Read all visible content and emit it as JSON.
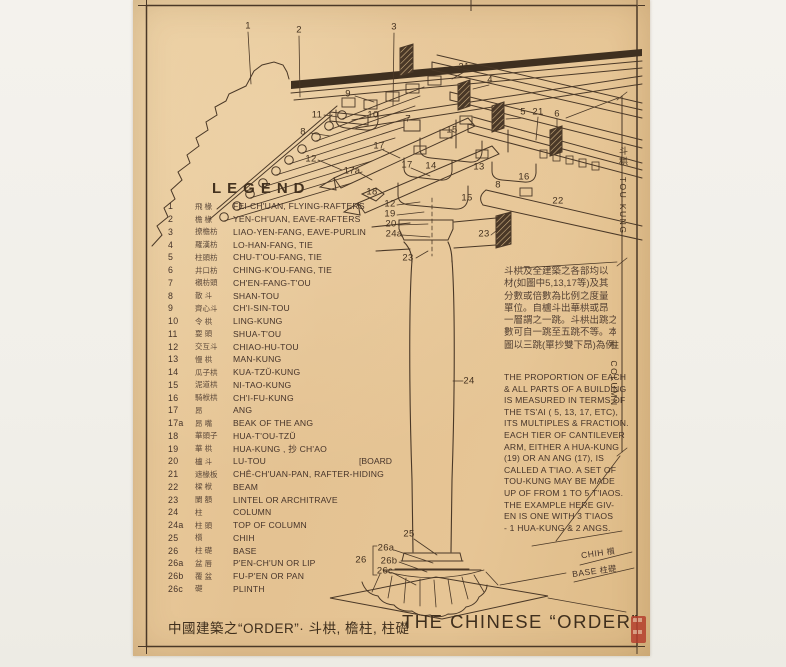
{
  "colors": {
    "background": "#f3f1ec",
    "paper": "#e6c596",
    "ink": "#4a3827",
    "seal_red": "#b5402e"
  },
  "legend": {
    "heading": "LEGEND",
    "items": [
      {
        "num": "1",
        "cn": "飛 椽",
        "en": "FEI-CH'UAN, FLYING-RAFTERS"
      },
      {
        "num": "2",
        "cn": "檐 椽",
        "en": "YEN-CH'UAN, EAVE-RAFTERS"
      },
      {
        "num": "3",
        "cn": "撩檐枋",
        "en": "LIAO-YEN-FANG, EAVE-PURLIN"
      },
      {
        "num": "4",
        "cn": "羅漢枋",
        "en": "LO-HAN-FANG, TIE"
      },
      {
        "num": "5",
        "cn": "柱頭枋",
        "en": "CHU-T'OU-FANG, TIE"
      },
      {
        "num": "6",
        "cn": "井口枋",
        "en": "CHING-K'OU-FANG, TIE"
      },
      {
        "num": "7",
        "cn": "襯枋頭",
        "en": "CH'EN-FANG-T'OU"
      },
      {
        "num": "8",
        "cn": "散 斗",
        "en": "SHAN-TOU"
      },
      {
        "num": "9",
        "cn": "齊心斗",
        "en": "CH'I-SIN-TOU"
      },
      {
        "num": "10",
        "cn": "令 栱",
        "en": "LING-KUNG"
      },
      {
        "num": "11",
        "cn": "耍 頭",
        "en": "SHUA-T'OU"
      },
      {
        "num": "12",
        "cn": "交互斗",
        "en": "CHIAO-HU-TOU"
      },
      {
        "num": "13",
        "cn": "慢 栱",
        "en": "MAN-KUNG"
      },
      {
        "num": "14",
        "cn": "瓜子栱",
        "en": "KUA-TZŬ-KUNG"
      },
      {
        "num": "15",
        "cn": "泥道栱",
        "en": "NI-TAO-KUNG"
      },
      {
        "num": "16",
        "cn": "騎栿栱",
        "en": "CH'I-FU-KUNG"
      },
      {
        "num": "17",
        "cn": "昂",
        "en": "ANG"
      },
      {
        "num": "17a",
        "cn": "昂 嘴",
        "en": "BEAK OF THE ANG"
      },
      {
        "num": "18",
        "cn": "華頭子",
        "en": "HUA-T'OU-TZŬ"
      },
      {
        "num": "19",
        "cn": "華 栱",
        "en": "HUA-KUNG , 抄 CH'AO"
      },
      {
        "num": "20",
        "cn": "櫨 斗",
        "en": "LU-TOU",
        "en2": "[BOARD"
      },
      {
        "num": "21",
        "cn": "遮椽板",
        "en": "CHÊ-CH'UAN-PAN, RAFTER-HIDING"
      },
      {
        "num": "22",
        "cn": "樑 栿",
        "en": "BEAM"
      },
      {
        "num": "23",
        "cn": "闌 額",
        "en": "LINTEL OR ARCHITRAVE"
      },
      {
        "num": "24",
        "cn": "柱",
        "en": "COLUMN"
      },
      {
        "num": "24a",
        "cn": "柱 頭",
        "en": "TOP OF COLUMN"
      },
      {
        "num": "25",
        "cn": "櫍",
        "en": "CHIH"
      },
      {
        "num": "26",
        "cn": "柱 礎",
        "en": "BASE"
      },
      {
        "num": "26a",
        "cn": "盆 唇",
        "en": "P'EN-CH'UN OR LIP"
      },
      {
        "num": "26b",
        "cn": "覆 盆",
        "en": "FU-P'EN OR PAN"
      },
      {
        "num": "26c",
        "cn": "礎",
        "en": "PLINTH"
      }
    ]
  },
  "notes": {
    "chinese_lines": [
      "斗栱及全建築之各部均以",
      "材(如圖中5,13,17等)及其",
      "分數或倍數為比例之度量",
      "單位。自櫨斗出華栱或昂",
      "一層謂之一跳。斗栱出跳之",
      "數可自一跳至五跳不等。本",
      "圖以三跳(單抄雙下昂)為例。"
    ],
    "english_lines": [
      "THE PROPORTION OF EACH",
      "& ALL PARTS OF A BUILDING",
      "IS MEASURED IN TERMS OF",
      "THE TS'AI ( 5, 13, 17, ETC),",
      "ITS MULTIPLES & FRACTION.",
      "EACH TIER OF CANTILEVER",
      "ARM, EITHER A HUA-KUNG",
      "(19) OR AN ANG (17), IS",
      "CALLED A T'IAO. A SET OF",
      "TOU-KUNG MAY BE MADE",
      "UP OF FROM 1 TO 5 T'IAOS.",
      "THE EXAMPLE HERE GIV-",
      "EN IS ONE WITH 3 T'IAOS",
      "- 1 HUA-KUNG & 2 ANGS."
    ]
  },
  "dimensions": {
    "tou_kung_cn": "斗栱",
    "tou_kung_en": "TOU-KUNG",
    "column_cn": "柱",
    "column_en": "COLUMN",
    "chih_en": "CHIH",
    "chih_cn": "櫍",
    "base_en": "BASE",
    "base_cn": "柱礎"
  },
  "titles": {
    "bottom_cn": "中國建築之“ORDER”· 斗栱, 檐柱, 柱礎",
    "bottom_en": "THE CHINESE “ORDER”"
  },
  "callouts": [
    {
      "label": "1",
      "x": 248,
      "y": 26
    },
    {
      "label": "2",
      "x": 299,
      "y": 30
    },
    {
      "label": "3",
      "x": 394,
      "y": 27
    },
    {
      "label": "21",
      "x": 464,
      "y": 67
    },
    {
      "label": "4",
      "x": 490,
      "y": 80
    },
    {
      "label": "5",
      "x": 523,
      "y": 112
    },
    {
      "label": "21",
      "x": 538,
      "y": 112
    },
    {
      "label": "6",
      "x": 557,
      "y": 114
    },
    {
      "label": "8",
      "x": 371,
      "y": 79
    },
    {
      "label": "9",
      "x": 348,
      "y": 94
    },
    {
      "label": "11",
      "x": 317,
      "y": 115
    },
    {
      "label": "10",
      "x": 373,
      "y": 115
    },
    {
      "label": "7",
      "x": 408,
      "y": 119
    },
    {
      "label": "8",
      "x": 303,
      "y": 132
    },
    {
      "label": "12",
      "x": 311,
      "y": 159
    },
    {
      "label": "15",
      "x": 452,
      "y": 130
    },
    {
      "label": "13",
      "x": 479,
      "y": 167
    },
    {
      "label": "14",
      "x": 431,
      "y": 166
    },
    {
      "label": "17",
      "x": 379,
      "y": 146
    },
    {
      "label": "17a",
      "x": 352,
      "y": 171
    },
    {
      "label": "17",
      "x": 407,
      "y": 165
    },
    {
      "label": "18",
      "x": 372,
      "y": 192
    },
    {
      "label": "12",
      "x": 390,
      "y": 204
    },
    {
      "label": "19",
      "x": 390,
      "y": 214
    },
    {
      "label": "20",
      "x": 391,
      "y": 224
    },
    {
      "label": "24a",
      "x": 394,
      "y": 234
    },
    {
      "label": "23",
      "x": 408,
      "y": 258
    },
    {
      "label": "23",
      "x": 484,
      "y": 234
    },
    {
      "label": "8",
      "x": 498,
      "y": 185
    },
    {
      "label": "15",
      "x": 467,
      "y": 198
    },
    {
      "label": "16",
      "x": 524,
      "y": 177
    },
    {
      "label": "22",
      "x": 558,
      "y": 201
    },
    {
      "label": "24",
      "x": 469,
      "y": 381
    },
    {
      "label": "25",
      "x": 409,
      "y": 534
    },
    {
      "label": "26a",
      "x": 386,
      "y": 548
    },
    {
      "label": "26",
      "x": 361,
      "y": 560
    },
    {
      "label": "26b",
      "x": 389,
      "y": 561
    },
    {
      "label": "26c",
      "x": 385,
      "y": 571
    }
  ]
}
